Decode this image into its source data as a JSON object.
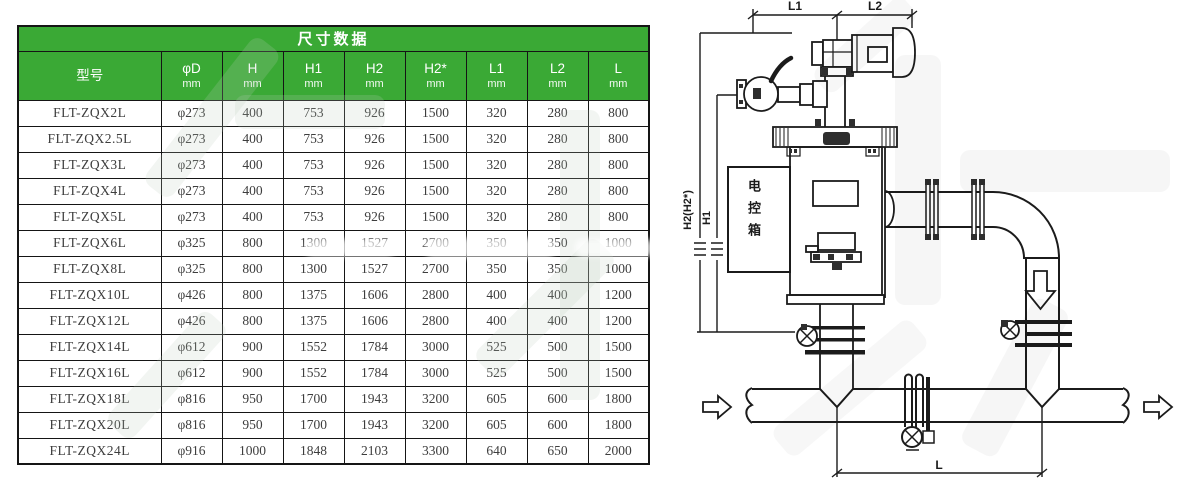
{
  "table": {
    "title": "尺寸数据",
    "unit_label": "mm",
    "columns": [
      {
        "label": "型号",
        "unit": ""
      },
      {
        "label": "φD",
        "unit": "mm"
      },
      {
        "label": "H",
        "unit": "mm"
      },
      {
        "label": "H1",
        "unit": "mm"
      },
      {
        "label": "H2",
        "unit": "mm"
      },
      {
        "label": "H2*",
        "unit": "mm"
      },
      {
        "label": "L1",
        "unit": "mm"
      },
      {
        "label": "L2",
        "unit": "mm"
      },
      {
        "label": "L",
        "unit": "mm"
      }
    ],
    "rows": [
      [
        "FLT-ZQX2L",
        "φ273",
        "400",
        "753",
        "926",
        "1500",
        "320",
        "280",
        "800"
      ],
      [
        "FLT-ZQX2.5L",
        "φ273",
        "400",
        "753",
        "926",
        "1500",
        "320",
        "280",
        "800"
      ],
      [
        "FLT-ZQX3L",
        "φ273",
        "400",
        "753",
        "926",
        "1500",
        "320",
        "280",
        "800"
      ],
      [
        "FLT-ZQX4L",
        "φ273",
        "400",
        "753",
        "926",
        "1500",
        "320",
        "280",
        "800"
      ],
      [
        "FLT-ZQX5L",
        "φ273",
        "400",
        "753",
        "926",
        "1500",
        "320",
        "280",
        "800"
      ],
      [
        "FLT-ZQX6L",
        "φ325",
        "800",
        "1300",
        "1527",
        "2700",
        "350",
        "350",
        "1000"
      ],
      [
        "FLT-ZQX8L",
        "φ325",
        "800",
        "1300",
        "1527",
        "2700",
        "350",
        "350",
        "1000"
      ],
      [
        "FLT-ZQX10L",
        "φ426",
        "800",
        "1375",
        "1606",
        "2800",
        "400",
        "400",
        "1200"
      ],
      [
        "FLT-ZQX12L",
        "φ426",
        "800",
        "1375",
        "1606",
        "2800",
        "400",
        "400",
        "1200"
      ],
      [
        "FLT-ZQX14L",
        "φ612",
        "900",
        "1552",
        "1784",
        "3000",
        "525",
        "500",
        "1500"
      ],
      [
        "FLT-ZQX16L",
        "φ612",
        "900",
        "1552",
        "1784",
        "3000",
        "525",
        "500",
        "1500"
      ],
      [
        "FLT-ZQX18L",
        "φ816",
        "950",
        "1700",
        "1943",
        "3200",
        "605",
        "600",
        "1800"
      ],
      [
        "FLT-ZQX20L",
        "φ816",
        "950",
        "1700",
        "1943",
        "3200",
        "605",
        "600",
        "1800"
      ],
      [
        "FLT-ZQX24L",
        "φ916",
        "1000",
        "1848",
        "2103",
        "3300",
        "640",
        "650",
        "2000"
      ]
    ]
  },
  "diagram": {
    "dim_l1": "L1",
    "dim_l2": "L2",
    "dim_h1": "H1",
    "dim_h2": "H2(H2*)",
    "dim_l": "L",
    "control_box_label": "电控箱"
  },
  "colors": {
    "header_green": "#3aa935",
    "grid_line": "#151515",
    "table_text": "#3d3d3d",
    "diagram_line": "#1b1b1b"
  }
}
